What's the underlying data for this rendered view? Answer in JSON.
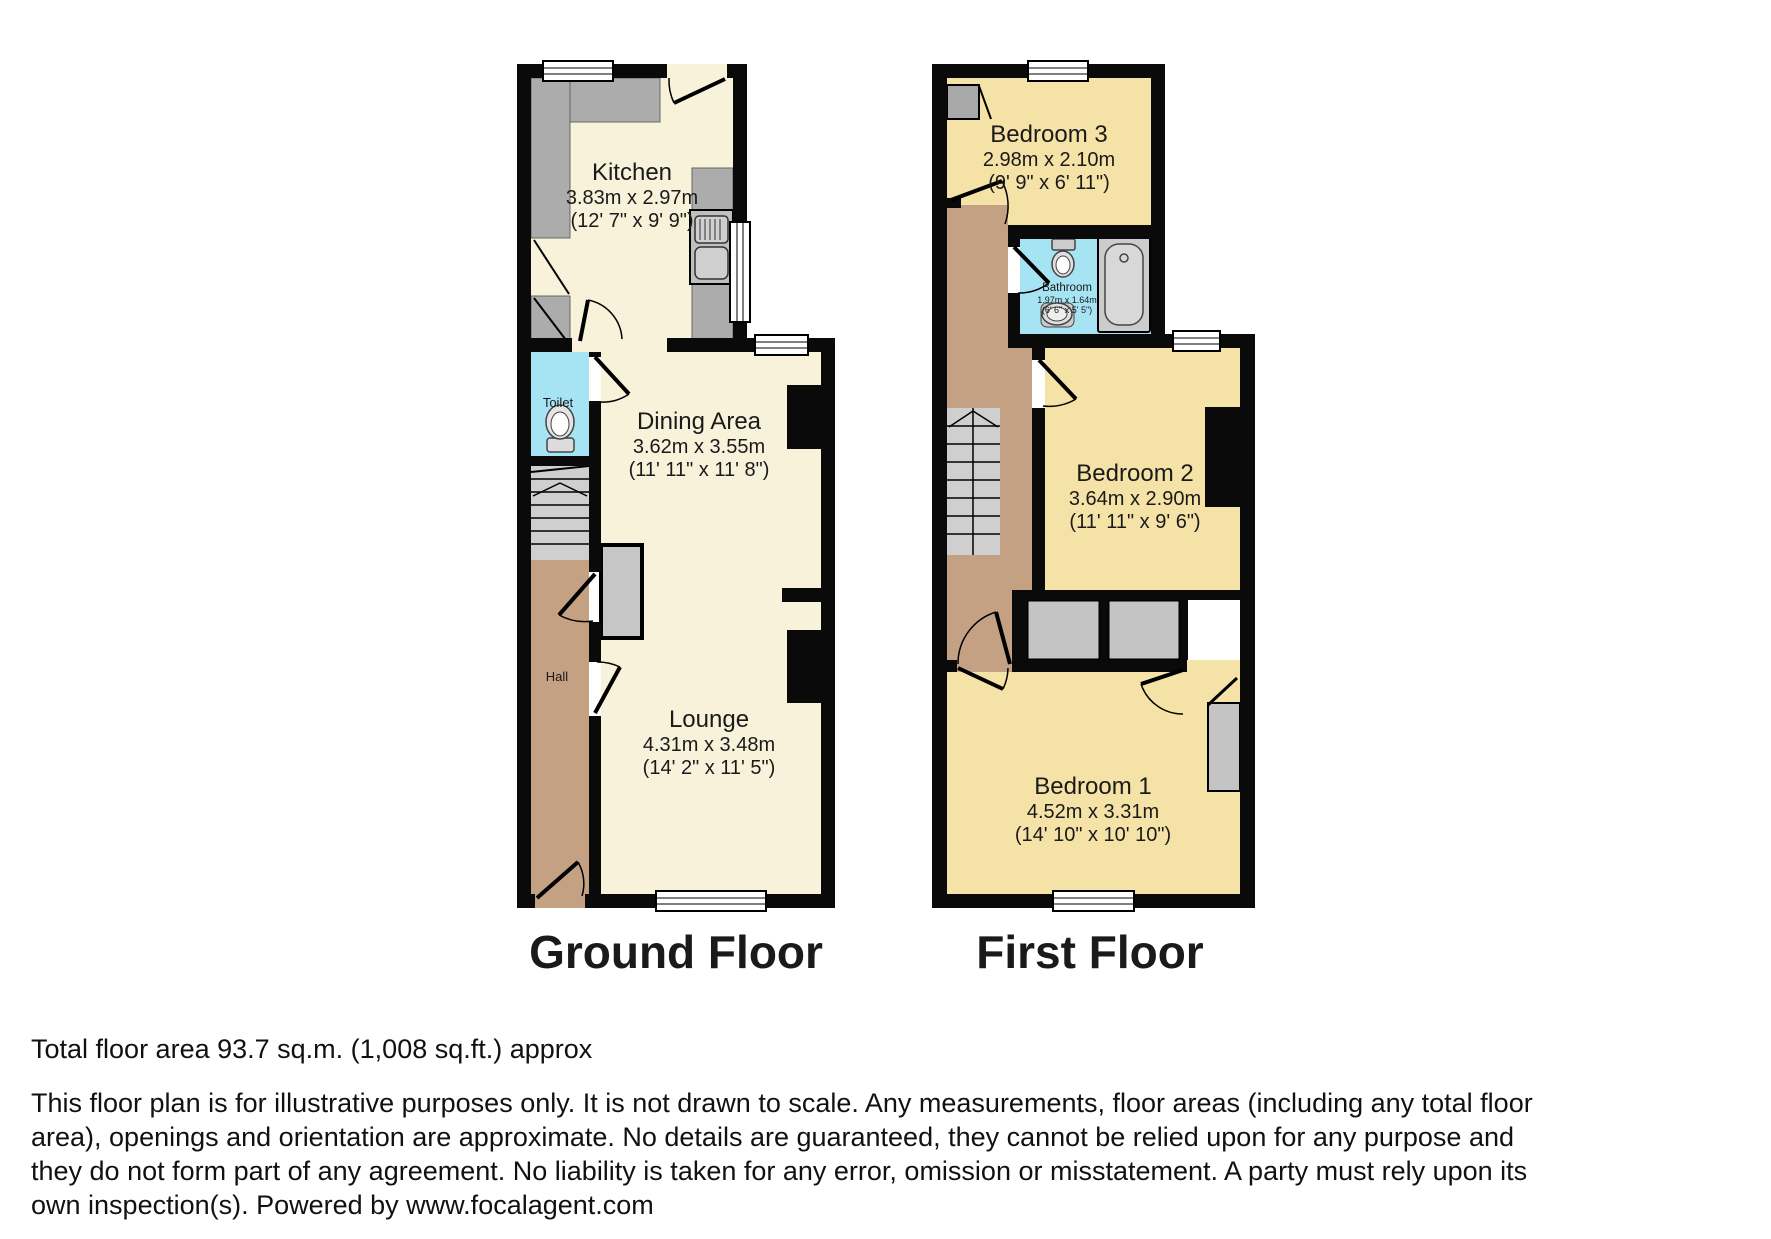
{
  "ground_floor": {
    "label": "Ground Floor",
    "rooms": {
      "kitchen": {
        "name": "Kitchen",
        "metric": "3.83m x 2.97m",
        "imperial": "(12' 7\" x 9' 9\")"
      },
      "dining": {
        "name": "Dining Area",
        "metric": "3.62m x 3.55m",
        "imperial": "(11' 11\" x 11' 8\")"
      },
      "lounge": {
        "name": "Lounge",
        "metric": "4.31m x 3.48m",
        "imperial": "(14' 2\" x 11' 5\")"
      },
      "toilet": {
        "name": "Toilet"
      },
      "hall": {
        "name": "Hall"
      }
    }
  },
  "first_floor": {
    "label": "First Floor",
    "rooms": {
      "bedroom3": {
        "name": "Bedroom 3",
        "metric": "2.98m x 2.10m",
        "imperial": "(9' 9\" x 6' 11\")"
      },
      "bathroom": {
        "name": "Bathroom",
        "metric": "1.97m x 1.64m",
        "imperial": "(6' 6\" x 5' 5\")"
      },
      "bedroom2": {
        "name": "Bedroom 2",
        "metric": "3.64m x 2.90m",
        "imperial": "(11' 11\" x 9' 6\")"
      },
      "bedroom1": {
        "name": "Bedroom 1",
        "metric": "4.52m x 3.31m",
        "imperial": "(14' 10\" x 10' 10\")"
      }
    }
  },
  "footer": {
    "total_area": "Total floor area 93.7 sq.m. (1,008 sq.ft.) approx",
    "disclaimer": "This floor plan is for illustrative purposes only. It is not drawn to scale. Any measurements, floor areas (including any total floor area), openings and orientation are approximate. No details are guaranteed, they cannot be relied upon for any purpose and they do not form part of any agreement. No liability is taken for any error, omission or misstatement. A party must rely upon its own inspection(s). Powered by www.focalagent.com"
  },
  "colors": {
    "wall": "#0a0a0a",
    "room_ground": "#f8f2db",
    "room_first": "#f5e2a7",
    "wet_room": "#a6e4f3",
    "hall": "#c5a184",
    "furniture_gray": "#c6c6c6"
  }
}
